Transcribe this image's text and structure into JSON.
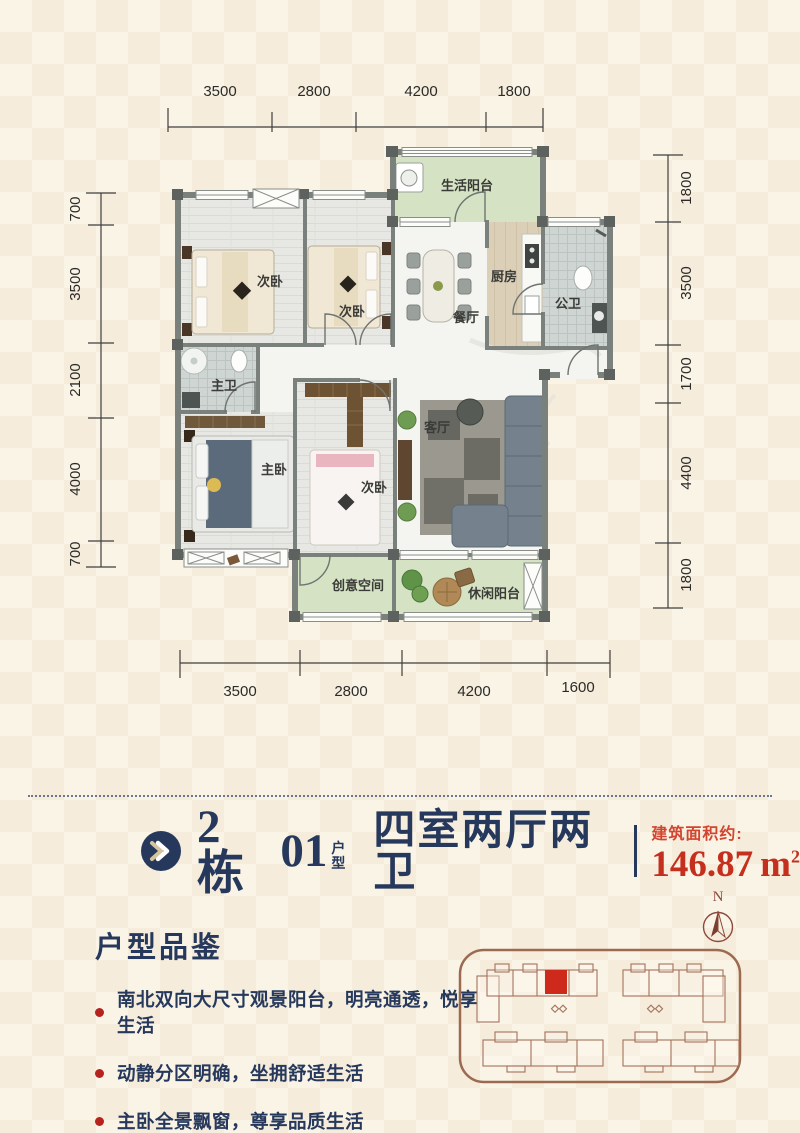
{
  "plan": {
    "dims": {
      "top": [
        "3500",
        "2800",
        "4200",
        "1800"
      ],
      "bottom": [
        "3500",
        "2800",
        "4200",
        "1600"
      ],
      "left": [
        "700",
        "3500",
        "2100",
        "4000",
        "700"
      ],
      "right": [
        "1800",
        "3500",
        "1700",
        "4400",
        "1800"
      ]
    },
    "rooms": {
      "life_balcony": "生活阳台",
      "bedroom_a": "次卧",
      "bedroom_b": "次卧",
      "dining": "餐厅",
      "kitchen": "厨房",
      "public_bath": "公卫",
      "master_bath": "主卫",
      "master_bedroom": "主卧",
      "bedroom_c": "次卧",
      "living": "客厅",
      "creative_space": "创意空间",
      "leisure_balcony": "休闲阳台"
    }
  },
  "title": {
    "building": "2栋",
    "unit_no": "01",
    "unit_char_top": "户",
    "unit_char_bottom": "型",
    "layout": "四室两厅两卫",
    "area_label": "建筑面积约:",
    "area_value": "146.87",
    "area_unit": "m",
    "area_sup": "2"
  },
  "features": {
    "heading": "户型品鉴",
    "items": [
      "南北双向大尺寸观景阳台，明亮通透，悦享生活",
      "动静分区明确，坐拥舒适生活",
      "主卧全景飘窗，尊享品质生活"
    ]
  },
  "compass": {
    "label": "N"
  },
  "colors": {
    "accent_navy": "#26395c",
    "accent_red": "#c52f1d",
    "wall_gray": "#7a807c",
    "balcony_green": "#d5e3c4",
    "site_plan_line": "#9c6a51",
    "background_cream": "#faf4e7"
  }
}
